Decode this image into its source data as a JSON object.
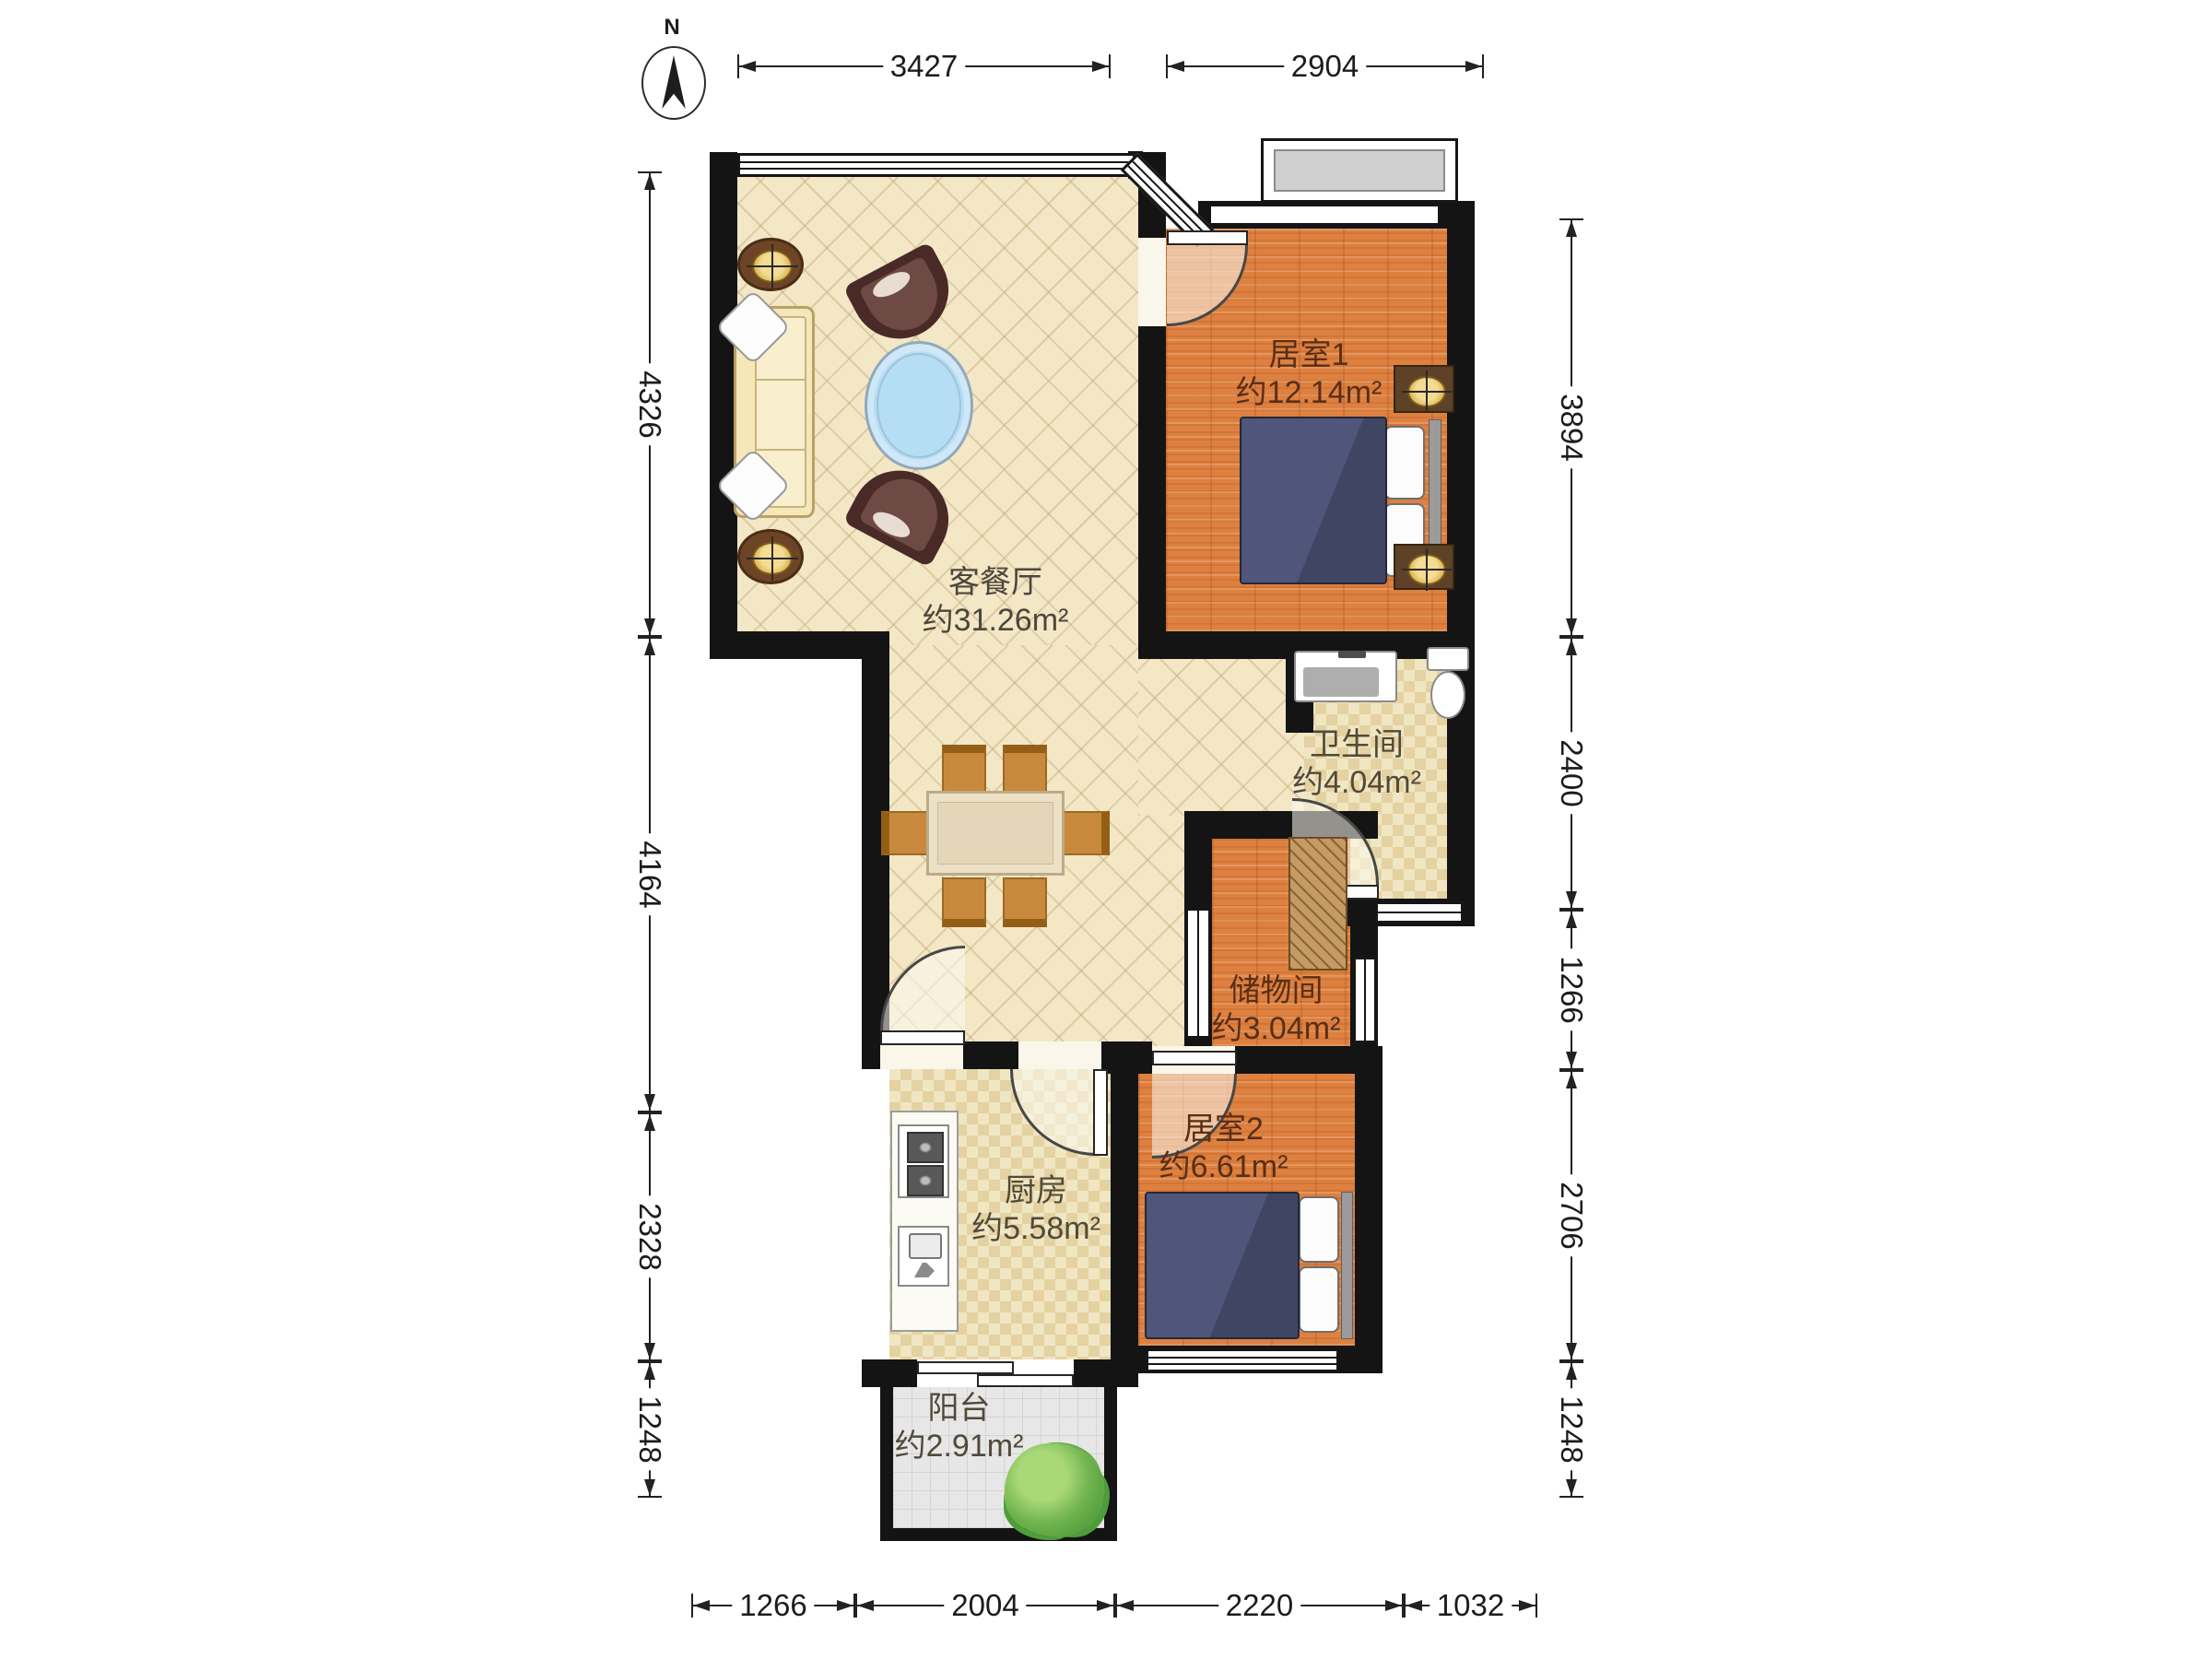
{
  "compass": {
    "label": "N"
  },
  "rooms": {
    "living": {
      "name": "客餐厅",
      "area": "约31.26m²"
    },
    "bedroom1": {
      "name": "居室1",
      "area": "约12.14m²"
    },
    "bathroom": {
      "name": "卫生间",
      "area": "约4.04m²"
    },
    "storage": {
      "name": "储物间",
      "area": "约3.04m²"
    },
    "bedroom2": {
      "name": "居室2",
      "area": "约6.61m²"
    },
    "kitchen": {
      "name": "厨房",
      "area": "约5.58m²"
    },
    "balcony": {
      "name": "阳台",
      "area": "约2.91m²"
    }
  },
  "dims": {
    "top": [
      "3427",
      "2904"
    ],
    "left": [
      "4326",
      "4164",
      "2328",
      "1248"
    ],
    "right": [
      "3894",
      "2400",
      "1266",
      "2706",
      "1248"
    ],
    "bottom": [
      "1266",
      "2004",
      "2220",
      "1032"
    ]
  },
  "colors": {
    "wall": "#141414",
    "living_floor": "#f3e7c6",
    "wood_floor": "#dd8040",
    "tile_floor": "#f0e6c2",
    "balcony_floor": "#e7e7e7",
    "bed_duvet": "#474d6a",
    "coffee_table_glass": "#b5ddf4",
    "plant_green": "#5aa643"
  }
}
